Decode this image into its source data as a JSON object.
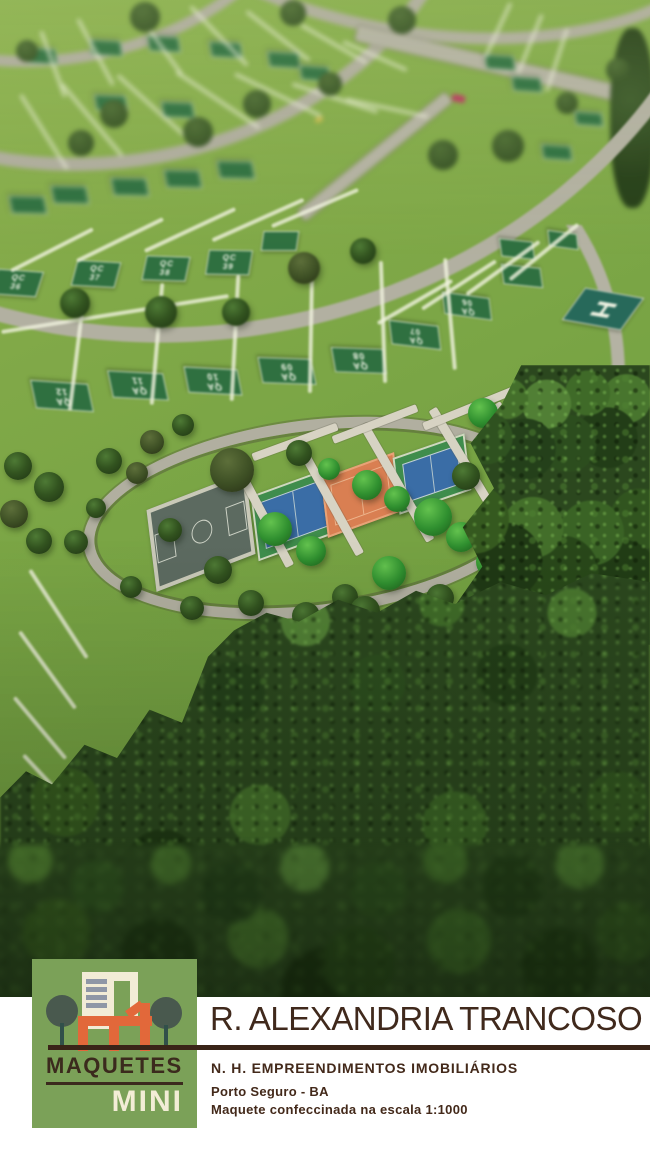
{
  "branding": {
    "maquetes": "MAQUETES",
    "mini": "MINI"
  },
  "footer": {
    "title": "R. ALEXANDRIA TRANCOSO",
    "company": "N. H. EMPREENDIMENTOS IMOBILIÁRIOS",
    "location": "Porto Seguro - BA",
    "scale_note": "Maquete confeccinada na escala 1:1000"
  },
  "model": {
    "helipad_letter": "H",
    "plots": [
      {
        "label": "QA 12"
      },
      {
        "label": "QA 11"
      },
      {
        "label": "QA 10"
      },
      {
        "label": "QA 09"
      },
      {
        "label": "QA 08"
      },
      {
        "label": "QA 07"
      },
      {
        "label": "QA 06"
      },
      {
        "label": "QC 36"
      },
      {
        "label": "QC 37"
      },
      {
        "label": "QC 38"
      },
      {
        "label": "QC 39"
      }
    ],
    "colors": {
      "lawn_green": "#7aa545",
      "forest_green": "#2b471e",
      "road_gray": "#b3b1a2",
      "sign_green": "#2f7040",
      "helipad_teal": "#27695a",
      "court_blue": "#3a6da6",
      "court_clay": "#d97f52",
      "logo_green": "#7ba158",
      "logo_orange": "#e2683a",
      "brand_brown": "#3a2418",
      "cream": "#f2ecd6"
    }
  }
}
